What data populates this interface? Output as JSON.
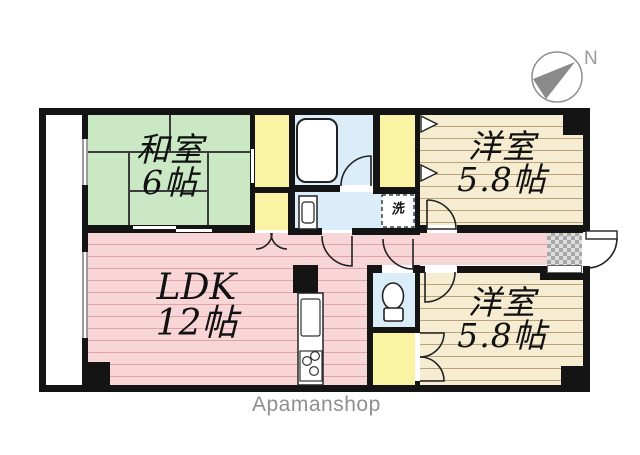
{
  "plan": {
    "rooms": {
      "washitsu": {
        "label": "和室",
        "size": "6帖"
      },
      "ldk": {
        "label": "LDK",
        "size": "12帖"
      },
      "youshitsu_north": {
        "label": "洋室",
        "size": "5.8帖"
      },
      "youshitsu_south": {
        "label": "洋室",
        "size": "5.8帖"
      }
    },
    "fixtures": {
      "washing_machine_label": "洗"
    },
    "compass": {
      "north_label": "N"
    },
    "watermark": "Apamanshop",
    "colors": {
      "wall": "#141414",
      "tatami_green": "#c9e8c3",
      "ldk_pink": "#f8d6d8",
      "flooring_beige": "#f6ecd2",
      "closet_yellow": "#faf3a4",
      "wet_area_blue": "#daedf8",
      "watermark_gray": "#8f8f8f"
    }
  }
}
